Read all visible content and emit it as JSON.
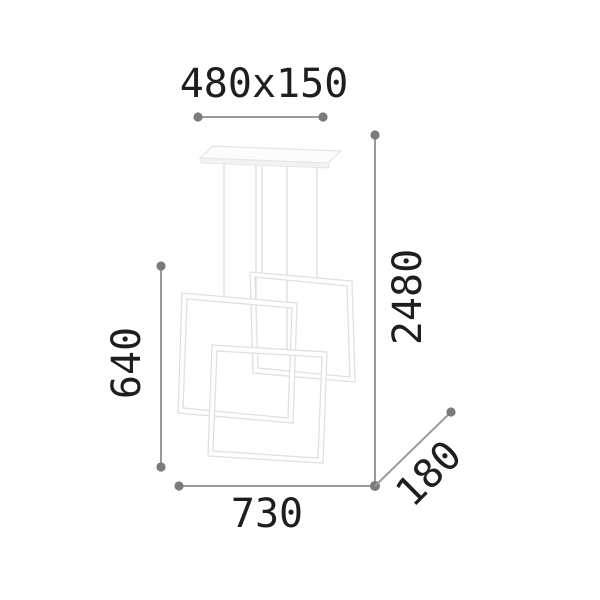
{
  "dimensions": {
    "canopy_label": "480x150",
    "drop_height_label": "2480",
    "frame_side_label": "640",
    "overall_width_label": "730",
    "depth_label": "180"
  },
  "drawing": {
    "parts": [
      "ceiling-canopy",
      "suspension-wires",
      "square-frame-back",
      "square-frame-middle",
      "square-frame-front"
    ]
  },
  "colors": {
    "background": "#ffffff",
    "dimension_line": "#9b9b9b",
    "dimension_dot": "#7b7b7b",
    "label_text": "#1e1e1e",
    "lamp_outline": "#e0e0e0",
    "lamp_fill": "#ffffff",
    "wire": "#d8d8d8"
  }
}
